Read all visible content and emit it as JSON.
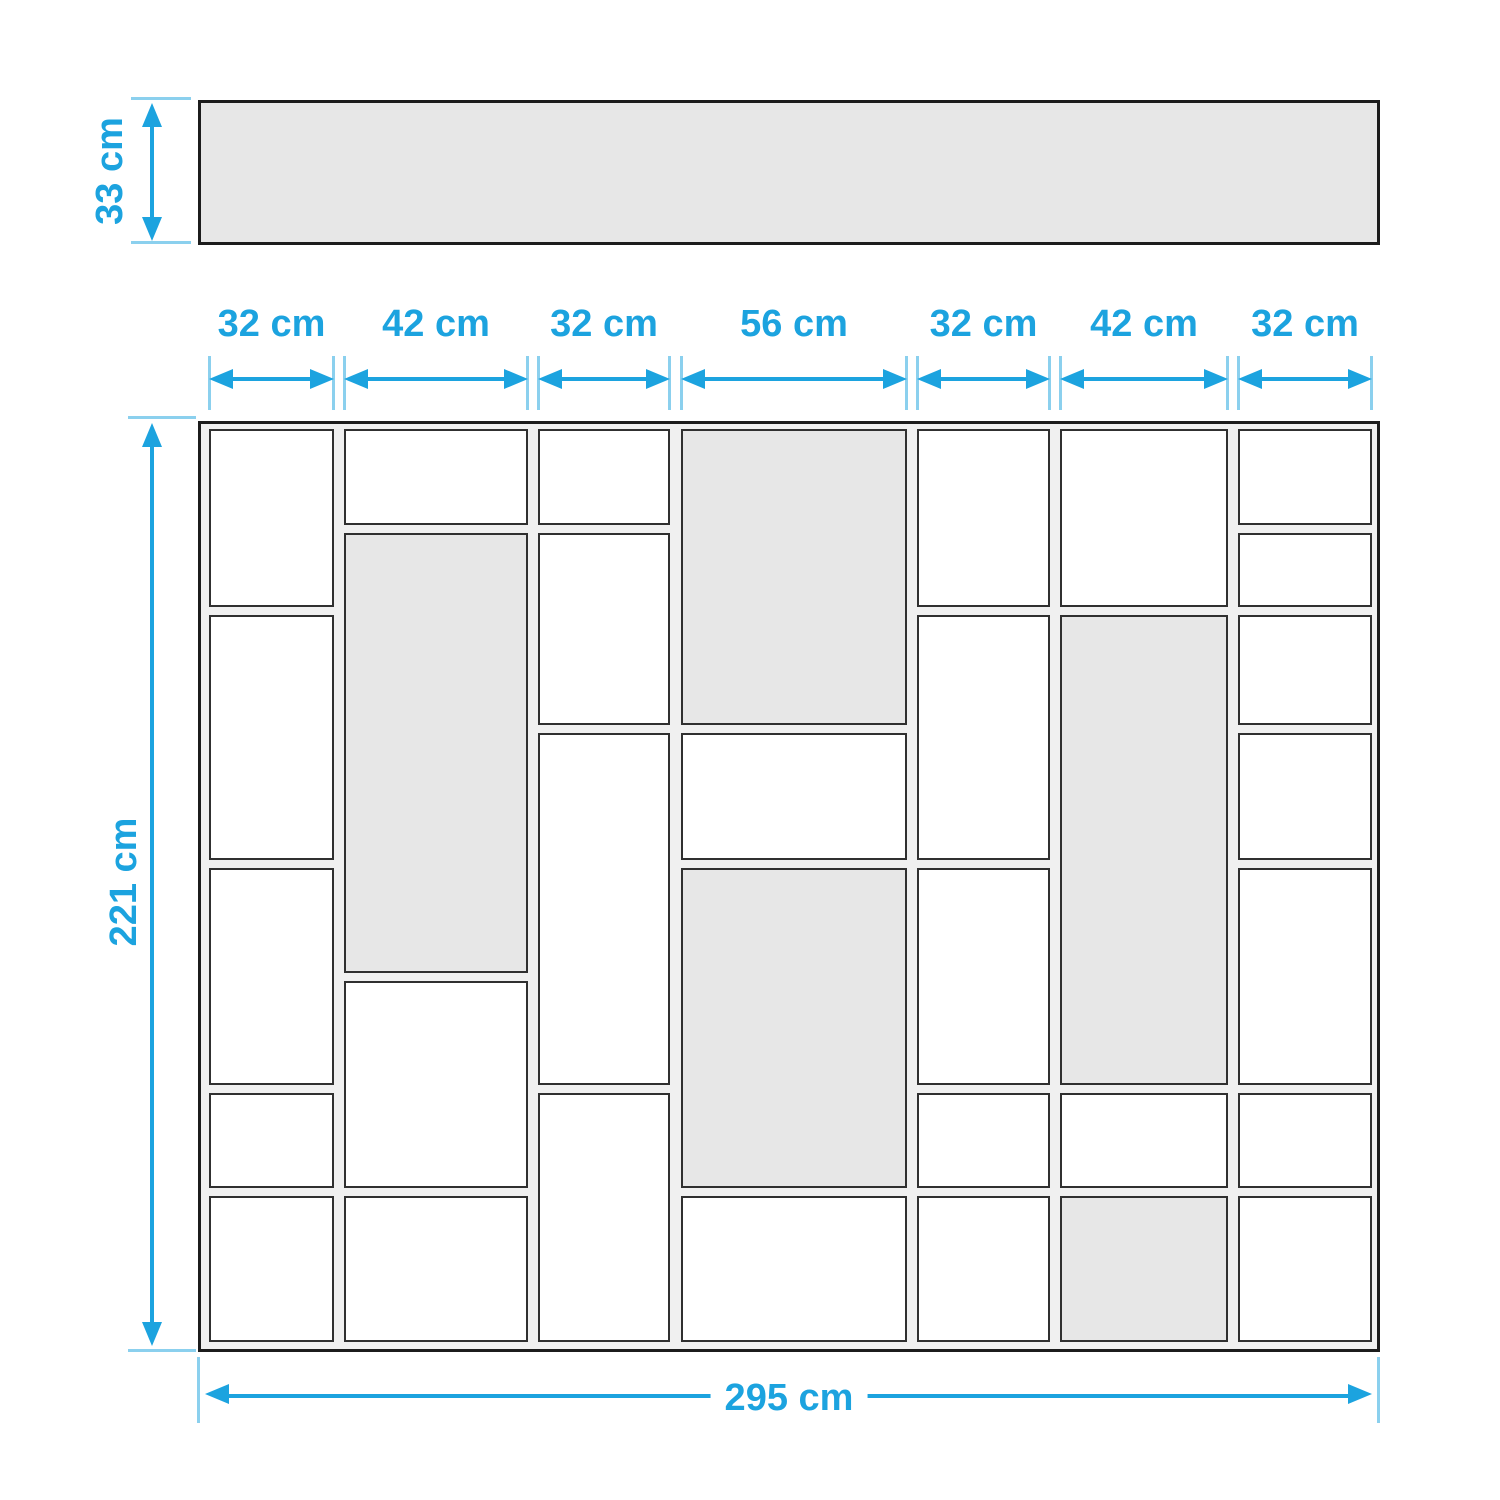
{
  "figure": "shelving-unit-dimension-diagram",
  "colors": {
    "accent_blue": "#1CA3DF",
    "tick_blue": "#8BD0EE",
    "outline_dark": "#1C1C1C",
    "cell_border": "#303030",
    "panel_fill": "#F0F0F0",
    "shaded_fill": "#E7E7E7",
    "open_fill": "#FFFFFF"
  },
  "top_bar": {
    "x": 198,
    "y": 100,
    "w": 1182,
    "h": 145
  },
  "depth_dim": {
    "label": "33 cm",
    "line_x": 150,
    "y1": 103,
    "y2": 241,
    "tick_y1": 97,
    "tick_y2": 241,
    "tick_x": 131,
    "tick_w": 60,
    "label_cx": 110,
    "label_cy": 171
  },
  "height_dim": {
    "label": "221 cm",
    "line_x": 150,
    "y1": 423,
    "y2": 1346,
    "tick_y1": 416,
    "tick_y2": 1349,
    "tick_x": 128,
    "tick_w": 68,
    "label_cx": 124,
    "label_cy": 882
  },
  "bottom_dim": {
    "label": "295 cm",
    "line_y": 1396,
    "x1": 205,
    "x2": 1372,
    "tick_x1": 197,
    "tick_x2": 1377,
    "tick_y": 1357,
    "tick_h": 66,
    "label_cx": 789,
    "label_cy": 1398
  },
  "width_dims": {
    "label_cy": 324,
    "arrow_cy": 379,
    "tick_y": 356,
    "tick_h": 54,
    "segments": [
      {
        "label": "32 cm",
        "from": 209,
        "to": 334
      },
      {
        "label": "42 cm",
        "from": 344,
        "to": 528
      },
      {
        "label": "32 cm",
        "from": 538,
        "to": 670
      },
      {
        "label": "56 cm",
        "from": 681,
        "to": 907
      },
      {
        "label": "32 cm",
        "from": 917,
        "to": 1050
      },
      {
        "label": "42 cm",
        "from": 1060,
        "to": 1228
      },
      {
        "label": "32 cm",
        "from": 1238,
        "to": 1372
      }
    ]
  },
  "unit": {
    "outer": {
      "x": 198,
      "y": 421,
      "w": 1182,
      "h": 931
    },
    "columns": [
      {
        "width_label": "32 cm",
        "x": 11,
        "w": 125,
        "cells": [
          {
            "y": 8,
            "h": 178,
            "shaded": false
          },
          {
            "y": 194,
            "h": 245,
            "shaded": false
          },
          {
            "y": 447,
            "h": 217,
            "shaded": false
          },
          {
            "y": 672,
            "h": 95,
            "shaded": false
          },
          {
            "y": 775,
            "h": 146,
            "shaded": false
          }
        ]
      },
      {
        "width_label": "42 cm",
        "x": 146,
        "w": 184,
        "cells": [
          {
            "y": 8,
            "h": 96,
            "shaded": false
          },
          {
            "y": 112,
            "h": 440,
            "shaded": true
          },
          {
            "y": 560,
            "h": 207,
            "shaded": false
          },
          {
            "y": 775,
            "h": 146,
            "shaded": false
          }
        ]
      },
      {
        "width_label": "32 cm",
        "x": 340,
        "w": 132,
        "cells": [
          {
            "y": 8,
            "h": 96,
            "shaded": false
          },
          {
            "y": 112,
            "h": 192,
            "shaded": false
          },
          {
            "y": 312,
            "h": 352,
            "shaded": false
          },
          {
            "y": 672,
            "h": 249,
            "shaded": false
          }
        ]
      },
      {
        "width_label": "56 cm",
        "x": 483,
        "w": 226,
        "cells": [
          {
            "y": 8,
            "h": 296,
            "shaded": true
          },
          {
            "y": 312,
            "h": 127,
            "shaded": false
          },
          {
            "y": 447,
            "h": 320,
            "shaded": true
          },
          {
            "y": 775,
            "h": 146,
            "shaded": false
          }
        ]
      },
      {
        "width_label": "32 cm",
        "x": 719,
        "w": 133,
        "cells": [
          {
            "y": 8,
            "h": 178,
            "shaded": false
          },
          {
            "y": 194,
            "h": 245,
            "shaded": false
          },
          {
            "y": 447,
            "h": 217,
            "shaded": false
          },
          {
            "y": 672,
            "h": 95,
            "shaded": false
          },
          {
            "y": 775,
            "h": 146,
            "shaded": false
          }
        ]
      },
      {
        "width_label": "42 cm",
        "x": 862,
        "w": 168,
        "cells": [
          {
            "y": 8,
            "h": 178,
            "shaded": false
          },
          {
            "y": 194,
            "h": 470,
            "shaded": true
          },
          {
            "y": 672,
            "h": 95,
            "shaded": false
          },
          {
            "y": 775,
            "h": 146,
            "shaded": true
          }
        ]
      },
      {
        "width_label": "32 cm",
        "x": 1040,
        "w": 134,
        "cells": [
          {
            "y": 8,
            "h": 96,
            "shaded": false
          },
          {
            "y": 112,
            "h": 74,
            "shaded": false
          },
          {
            "y": 194,
            "h": 110,
            "shaded": false
          },
          {
            "y": 312,
            "h": 127,
            "shaded": false
          },
          {
            "y": 447,
            "h": 217,
            "shaded": false
          },
          {
            "y": 672,
            "h": 95,
            "shaded": false
          },
          {
            "y": 775,
            "h": 146,
            "shaded": false
          }
        ]
      }
    ]
  }
}
